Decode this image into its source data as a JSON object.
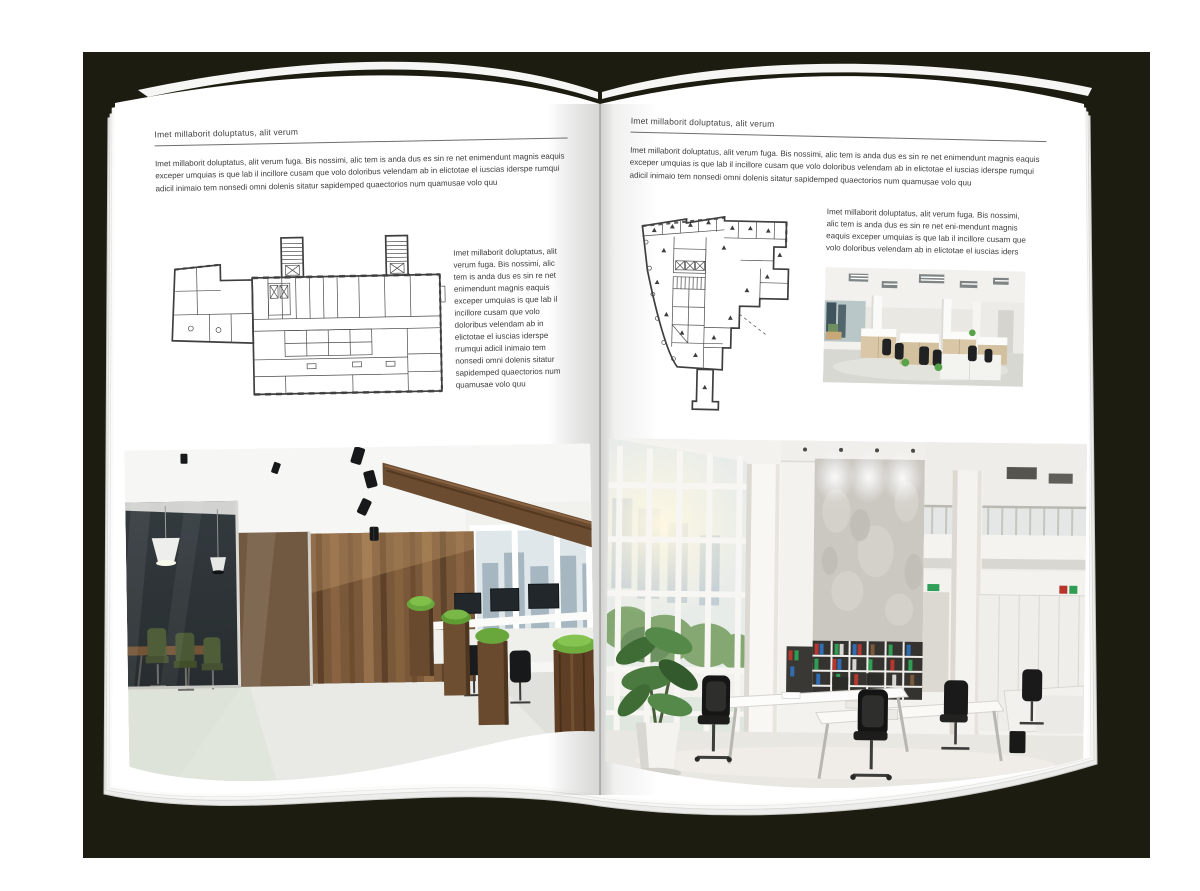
{
  "backdrop_color": "#1d1c11",
  "page_color": "#ffffff",
  "text_color": "#3c3c3c",
  "left_page": {
    "header": "Imet millaborit doluptatus, alit verum",
    "intro": "Imet millaborit doluptatus, alit verum fuga. Bis nossimi, alic tem is anda dus es sin re net enimendunt magnis eaquis exceper umquias is que lab il incillore cusam que volo doloribus velendam ab in elictotae el iuscias iderspe rumqui adicil inimaio tem nonsedi omni dolenis sitatur sapidemped quaectorios num quamusae volo quu",
    "side_text": "Imet millaborit doluptatus, alit verum fuga. Bis nossimi, alic tem is anda dus es sin re net enimendunt magnis eaquis exceper umquias is que lab il incillore cusam que volo doloribus velendam ab in elictotae el iuscias iderspe rrumqui adicil inimaio tem nonsedi omni dolenis sitatur sapidemped quaectorios num quamusae volo quu",
    "floor_plan_name": "wide-building-floor-plan",
    "photo_name": "wood-and-glass-office-interior"
  },
  "right_page": {
    "header": "Imet millaborit doluptatus, alit verum",
    "intro": "Imet millaborit doluptatus, alit verum fuga. Bis nossimi, alic tem is anda dus es sin re net enimendunt magnis eaquis exceper umquias is que lab il incillore cusam que volo doloribus velendam ab in elictotae el iuscias iderspe rumqui adicil inimaio tem nonsedi omni dolenis sitatur sapidemped quaectorios num quamusae volo quu",
    "side_text": "Imet millaborit doluptatus, alit verum fuga. Bis nossimi, alic tem is anda dus es sin re net eni-mendunt magnis eaquis exceper umquias is que lab il incillore cusam que volo doloribus velendam ab in elictotae el iuscias iders",
    "floor_plan_name": "irregular-building-floor-plan",
    "photo_small_name": "open-plan-office-cubicles",
    "photo_large_name": "bright-loft-office-interior"
  }
}
